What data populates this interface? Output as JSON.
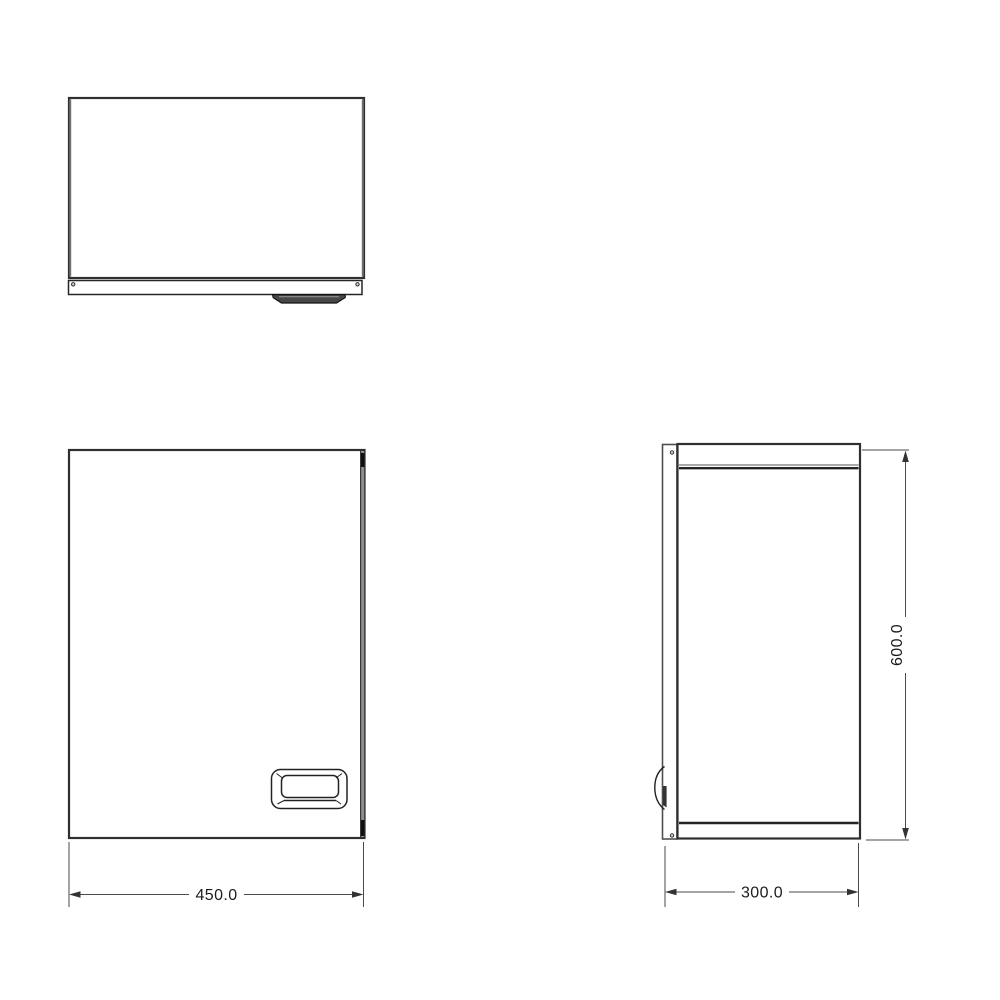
{
  "drawing": {
    "type": "cabinet-orthographic-projection",
    "views": {
      "top": {
        "label": "top-view"
      },
      "front": {
        "label": "front-view"
      },
      "side": {
        "label": "side-view"
      }
    },
    "dimensions": {
      "width": {
        "value": "450.0"
      },
      "depth": {
        "value": "300.0"
      },
      "height": {
        "value": "600.0"
      }
    },
    "colors": {
      "background": "#ffffff",
      "outline_dark": "#2f2f2f",
      "outline_gray": "#6f6f6f",
      "dimension_line": "#4a4a4a",
      "dimension_text": "#1c1c1c",
      "side_panel_gray": "#8f8f8f",
      "handle_fill": "#474747"
    }
  }
}
